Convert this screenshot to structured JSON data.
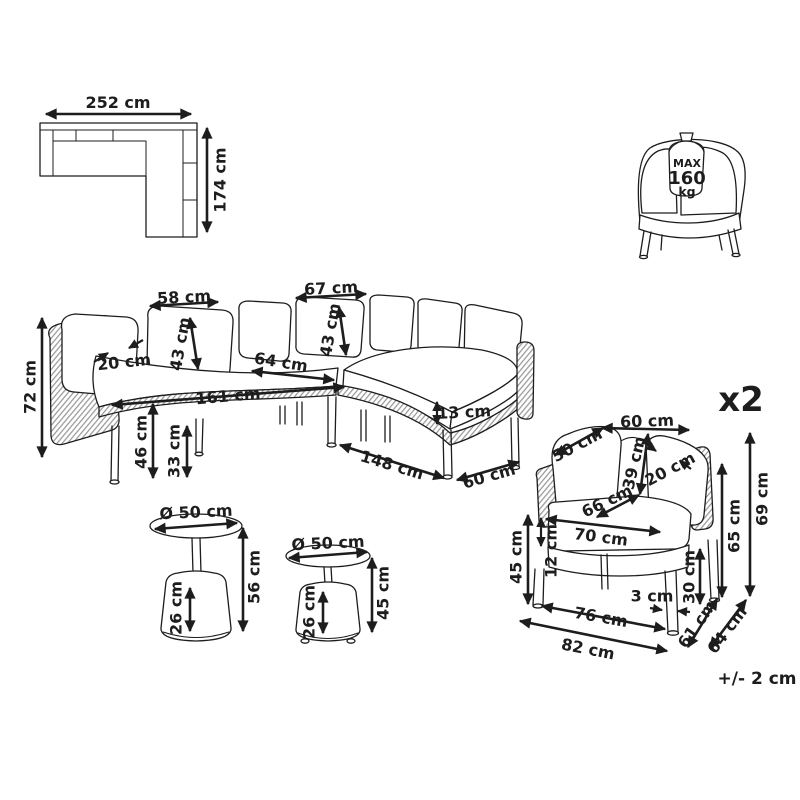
{
  "colors": {
    "ink": "#1d1d1d",
    "paper": "#ffffff",
    "weave_line": "#999999"
  },
  "top_view": {
    "width": "252 cm",
    "depth": "174 cm"
  },
  "weight_badge": {
    "label_max": "MAX",
    "value": "160",
    "unit": "kg"
  },
  "sofa": {
    "height": "72 cm",
    "back_cushion_thickness": "20 cm",
    "back_cushion_width_left": "58 cm",
    "back_cushion_height_left": "43 cm",
    "back_cushion_width_right": "67 cm",
    "back_cushion_height_right": "43 cm",
    "seat_depth": "64 cm",
    "seat_length_left": "161 cm",
    "seat_height": "46 cm",
    "clearance_height": "33 cm",
    "seat_cushion_thickness": "13 cm",
    "seat_length_right": "148 cm",
    "seat_depth_right": "60 cm"
  },
  "tables": {
    "large": {
      "diameter": "Ø 50 cm",
      "height": "56 cm",
      "base_height": "26 cm"
    },
    "small": {
      "diameter": "Ø 50 cm",
      "height": "45 cm",
      "base_height": "26 cm"
    }
  },
  "armchair": {
    "quantity": "x2",
    "back_width": "60 cm",
    "back_cushion_width": "50 cm",
    "back_cushion_height": "39 cm",
    "back_cushion_thickness": "20 cm",
    "seat_width_inner": "66 cm",
    "seat_width": "70 cm",
    "seat_height": "45 cm",
    "seat_cushion_thickness": "12 cm",
    "clearance_height": "30 cm",
    "armrest_height": "65 cm",
    "total_height": "69 cm",
    "leg_inset": "3 cm",
    "front_width": "76 cm",
    "total_width": "82 cm",
    "seat_depth_inner": "61 cm",
    "total_depth": "64 cm"
  },
  "footer": {
    "tolerance": "+/- 2 cm"
  }
}
